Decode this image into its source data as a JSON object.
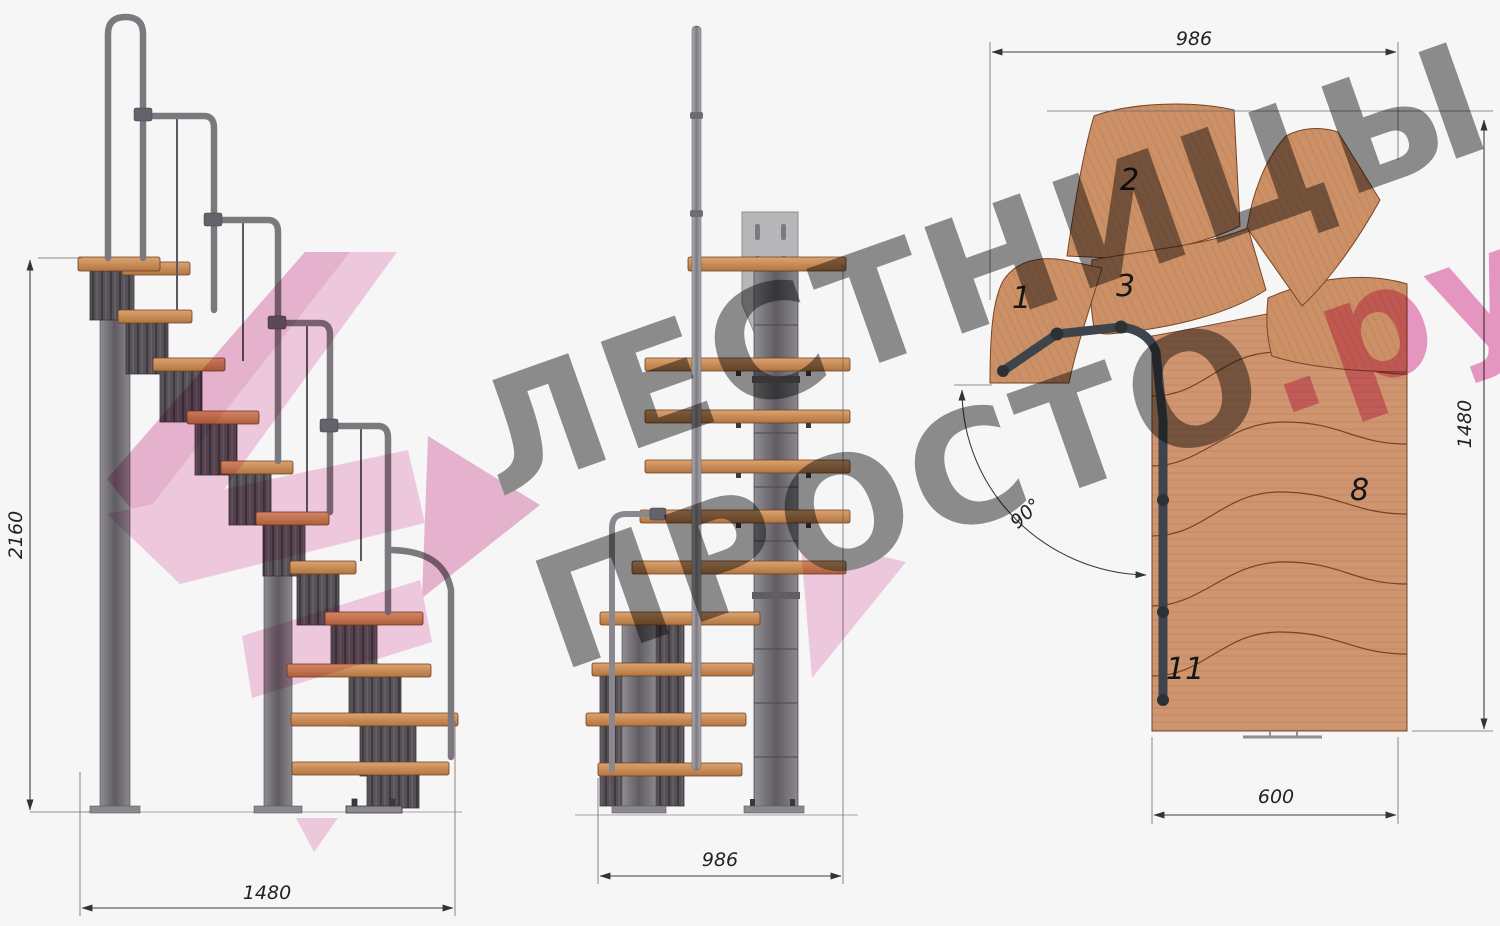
{
  "drawing": {
    "watermark": {
      "line1": "ЛЕСТНИЦЫ",
      "line2": "ПРОСТО",
      "suffix": ".ру"
    },
    "dims": {
      "side_height": "2160",
      "side_length": "1480",
      "front_width": "986",
      "plan_width": "986",
      "plan_depth": "1480",
      "plan_exit_width": "600",
      "plan_angle": "90°"
    },
    "steps": {
      "s1": "1",
      "s2": "2",
      "s3": "3",
      "s8": "8",
      "s11": "11"
    }
  },
  "colors": {
    "wood": "#cf9570",
    "metal_dark": "#565156",
    "metal_light": "#8e8c90",
    "dimension_line": "#3c3c3c",
    "watermark_grey": "#909090",
    "watermark_pink": "#ee9cc6",
    "ribbon_pink": "#f6cfe2"
  }
}
